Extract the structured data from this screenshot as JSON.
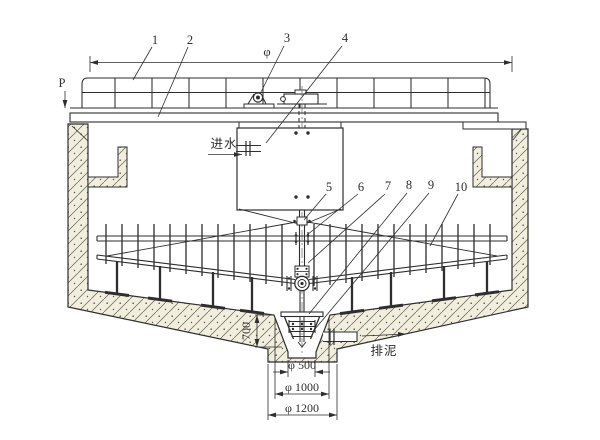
{
  "drawing_type": "engineering-section-drawing",
  "labels": {
    "p": "P",
    "phi": "φ"
  },
  "callouts": [
    {
      "n": "1"
    },
    {
      "n": "2"
    },
    {
      "n": "3"
    },
    {
      "n": "4"
    },
    {
      "n": "5"
    },
    {
      "n": "6"
    },
    {
      "n": "7"
    },
    {
      "n": "8"
    },
    {
      "n": "9"
    },
    {
      "n": "10"
    }
  ],
  "annotations": {
    "inlet": "进水",
    "sludge": "排泥"
  },
  "dimensions": {
    "hopper_depth": "700",
    "d500": "φ 500",
    "d1000": "φ 1000",
    "d1200": "φ 1200"
  },
  "colors": {
    "ink": "#2e2e2e",
    "concrete_fill": "#f1eedd",
    "hatch": "#62625a",
    "paper": "#ffffff"
  }
}
